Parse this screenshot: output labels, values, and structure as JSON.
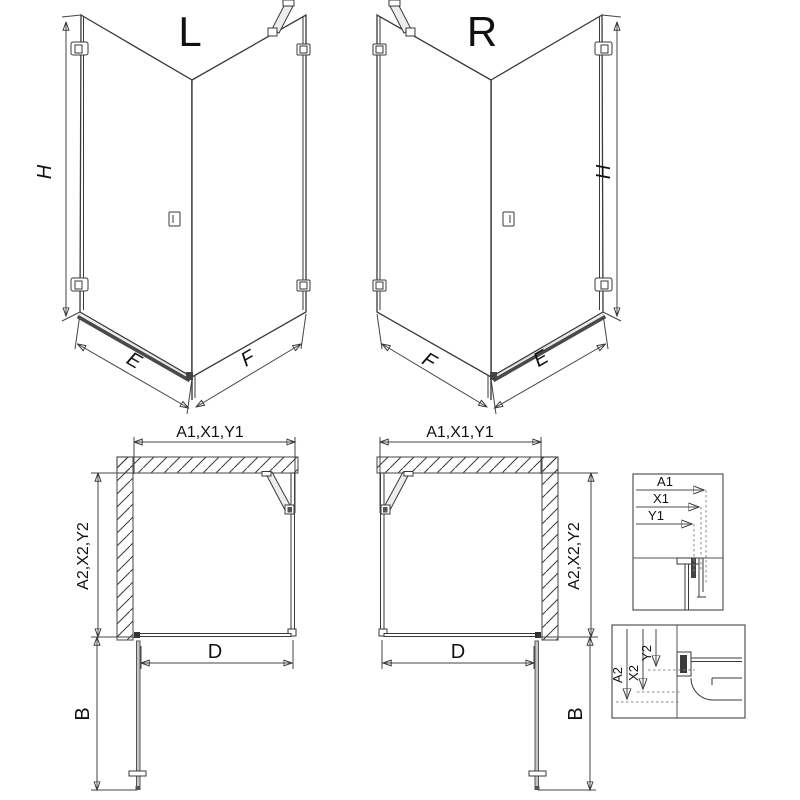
{
  "views": {
    "iso_left": {
      "label": "L",
      "dims": {
        "height": "H",
        "door_width": "E",
        "side_width": "F"
      }
    },
    "iso_right": {
      "label": "R",
      "dims": {
        "height": "H",
        "door_width": "E",
        "side_width": "F"
      }
    },
    "plan_left": {
      "dims": {
        "width_codes": "A1,X1,Y1",
        "depth_codes": "A2,X2,Y2",
        "door_opening": "D",
        "door_swing": "B"
      }
    },
    "plan_right": {
      "dims": {
        "width_codes": "A1,X1,Y1",
        "depth_codes": "A2,X2,Y2",
        "door_opening": "D",
        "door_swing": "B"
      }
    },
    "detail_width": {
      "dims": [
        "A1",
        "X1",
        "Y1"
      ]
    },
    "detail_depth": {
      "dims": [
        "A2",
        "X2",
        "Y2"
      ]
    }
  },
  "colors": {
    "background": "#ffffff",
    "line": "#3a3a3a",
    "dim_line": "#444444",
    "wall_hatch": "#777777",
    "detail_arrow": "#999999",
    "threshold": "#4a4a4a"
  }
}
